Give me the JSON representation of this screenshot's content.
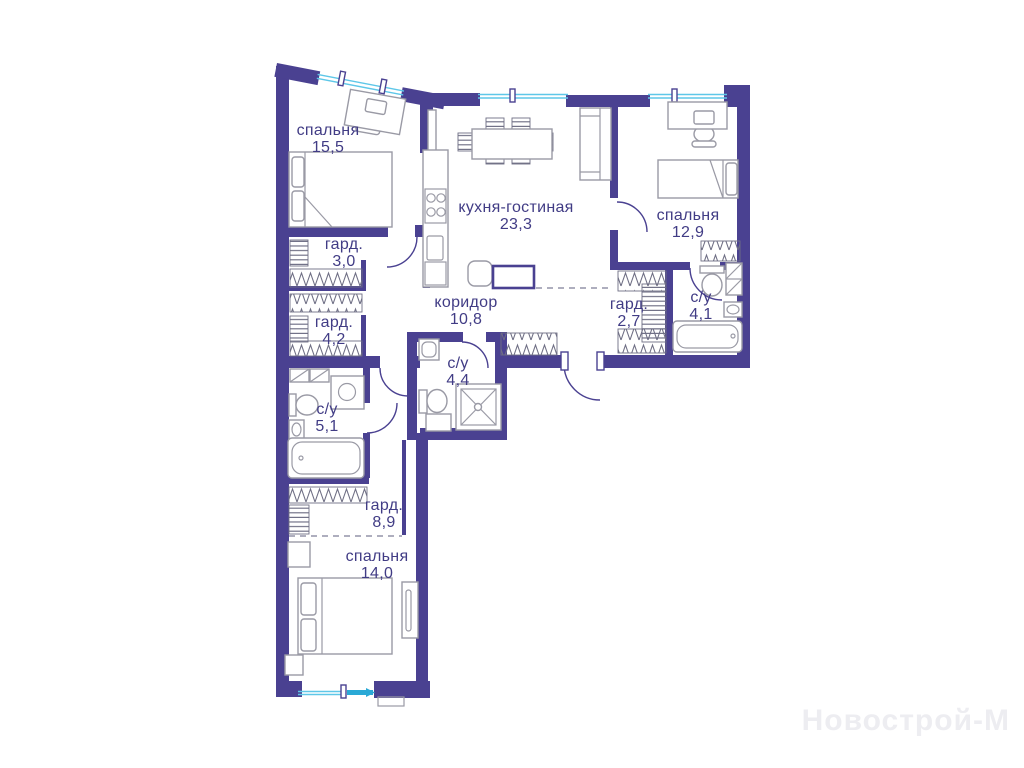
{
  "watermark": {
    "text": "Новострой-М"
  },
  "palette": {
    "bg": "#ffffff",
    "wall": "#4a4191",
    "window": "#5ec7e8",
    "window_bold": "#2aa9d6",
    "furniture": "#9a9aa5",
    "hatch": "#6e6e84",
    "dash": "#9393a8",
    "label": "#413c85",
    "watermark": "#ededf1"
  },
  "rooms": [
    {
      "id": "bedroom-1",
      "label": "спальня",
      "area": "15,5"
    },
    {
      "id": "kitchen-living",
      "label": "кухня-гостиная",
      "area": "23,3"
    },
    {
      "id": "bedroom-2",
      "label": "спальня",
      "area": "12,9"
    },
    {
      "id": "wardrobe-1",
      "label": "гард.",
      "area": "3,0"
    },
    {
      "id": "wardrobe-2",
      "label": "гард.",
      "area": "4,2"
    },
    {
      "id": "corridor",
      "label": "коридор",
      "area": "10,8"
    },
    {
      "id": "wardrobe-3",
      "label": "гард.",
      "area": "2,7"
    },
    {
      "id": "bathroom-1",
      "label": "с/у",
      "area": "4,1"
    },
    {
      "id": "bathroom-2",
      "label": "с/у",
      "area": "4,4"
    },
    {
      "id": "bathroom-3",
      "label": "с/у",
      "area": "5,1"
    },
    {
      "id": "wardrobe-4",
      "label": "гард.",
      "area": "8,9"
    },
    {
      "id": "bedroom-3",
      "label": "спальня",
      "area": "14,0"
    }
  ]
}
